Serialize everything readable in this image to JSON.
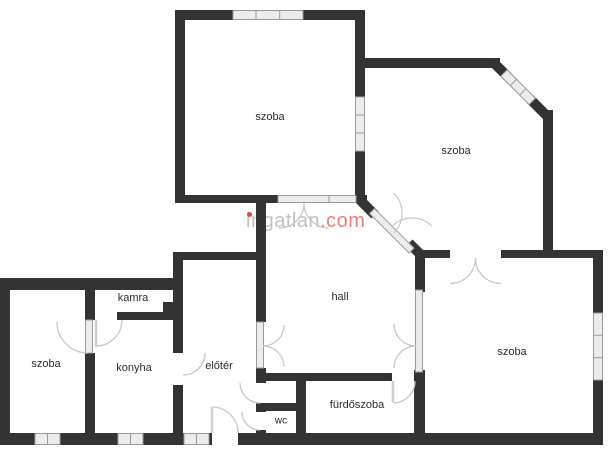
{
  "floorplan": {
    "rooms": {
      "room_top_left": {
        "label": "szoba"
      },
      "room_top_right": {
        "label": "szoba"
      },
      "room_bottom_right": {
        "label": "szoba"
      },
      "room_left": {
        "label": "szoba"
      },
      "pantry": {
        "label": "kamra"
      },
      "kitchen": {
        "label": "konyha"
      },
      "foyer": {
        "label": "előtér"
      },
      "hall": {
        "label": "hall"
      },
      "wc": {
        "label": "wc"
      },
      "bathroom": {
        "label": "fürdőszoba"
      }
    },
    "watermark": {
      "brand": "ingatlan",
      "tld": ".com"
    },
    "colors": {
      "wall": "#333333",
      "window_fill": "#ececec",
      "window_border": "#9b9b9b",
      "door_arc": "#c8c8c8",
      "door_leaf": "#cfcfcf",
      "label": "#2d2d2d",
      "watermark_gray": "#c1c1c1",
      "watermark_red": "#ea8076",
      "watermark_dot": "#e2483d"
    }
  }
}
